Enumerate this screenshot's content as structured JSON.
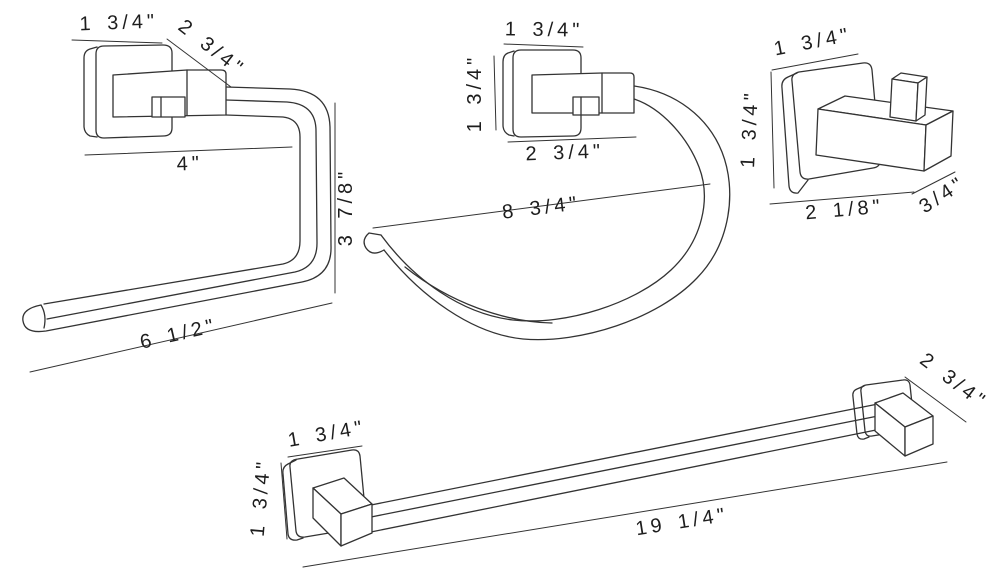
{
  "title": "Bathroom hardware set dimension drawing",
  "colors": {
    "background": "#ffffff",
    "line": "#333333",
    "text": "#1d1d1d"
  },
  "items": {
    "toilet_paper_holder": {
      "name": "toilet paper holder",
      "dims": {
        "plate_width": "1 3/4\"",
        "projection": "2 3/4\"",
        "arm_top": "4\"",
        "height": "3 7/8\"",
        "length": "6 1/2\""
      }
    },
    "towel_ring": {
      "name": "towel ring",
      "dims": {
        "plate_width": "1 3/4\"",
        "plate_height": "1 3/4\"",
        "projection": "2 3/4\"",
        "ring_width": "8 3/4\""
      }
    },
    "robe_hook": {
      "name": "robe hook",
      "dims": {
        "plate_width": "1 3/4\"",
        "plate_height": "1 3/4\"",
        "base_width": "2 1/8\"",
        "hook_width": "3/4\""
      }
    },
    "towel_bar": {
      "name": "towel bar",
      "dims": {
        "post_width": "1 3/4\"",
        "post_height": "1 3/4\"",
        "post_projection": "2 3/4\"",
        "bar_length": "19 1/4\""
      }
    }
  }
}
